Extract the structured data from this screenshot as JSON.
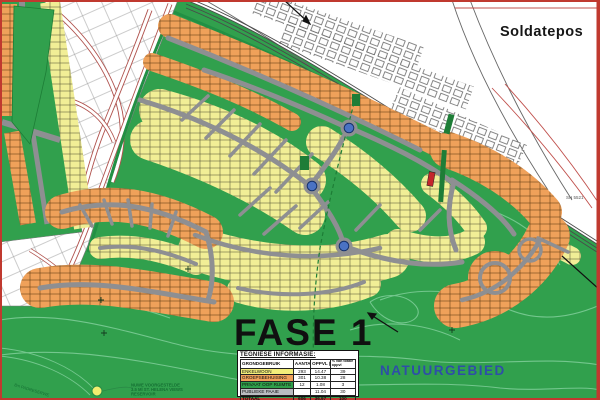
{
  "map": {
    "area_name": "Soldatepos",
    "phase_label": "FASE 1",
    "nature_area_label": "NATUURGEBIED",
    "erf_ref": "SH 5521",
    "road_reserve_label": "8m PADRESERWE",
    "reservoir_note": {
      "line1": "NUWE VOORGESTELDE",
      "line2": "3.5 Ml ST. HELENA VIEWS",
      "line3": "RESERVOIR"
    },
    "colors": {
      "nature_green": "#31a04d",
      "contour_green": "#74c78e",
      "plot_orange": "#efa15a",
      "plot_yellow": "#f1ee96",
      "road_gray": "#8e8f92",
      "private_open_green": "#1e7d37",
      "red_erf": "#c4262c",
      "roundabout_blue": "#4a72c4",
      "nature_label_blue": "#2e4ea8",
      "border_red": "#c0392f"
    }
  },
  "legend_table": {
    "title": "TEGNIESE INFORMASIE:",
    "headers": [
      "GRONDGEBRUIK",
      "AANTAL",
      "OPPVL (ha)",
      "% van totale oppvl"
    ],
    "rows": [
      {
        "label": "ENKELWOON",
        "aantal": "293",
        "oppvl": "14.47",
        "persent": "39",
        "highlight": "#f2ee7a"
      },
      {
        "label": "GROEPSBEHUISING",
        "aantal": "301",
        "oppvl": "10.38",
        "persent": "28",
        "highlight": "#efa05a"
      },
      {
        "label": "PRIVAAT OOP RUIMTE",
        "aantal": "12",
        "oppvl": "1.08",
        "persent": "3",
        "highlight": "#2f9e4a"
      },
      {
        "label": "PUBLIEKE PAAIE",
        "aantal": "",
        "oppvl": "11.04",
        "persent": "30",
        "highlight": "#b9bcc0"
      },
      {
        "label": "TOTAAL",
        "aantal": "606",
        "oppvl": "36.97",
        "persent": "100",
        "highlight": ""
      }
    ]
  }
}
